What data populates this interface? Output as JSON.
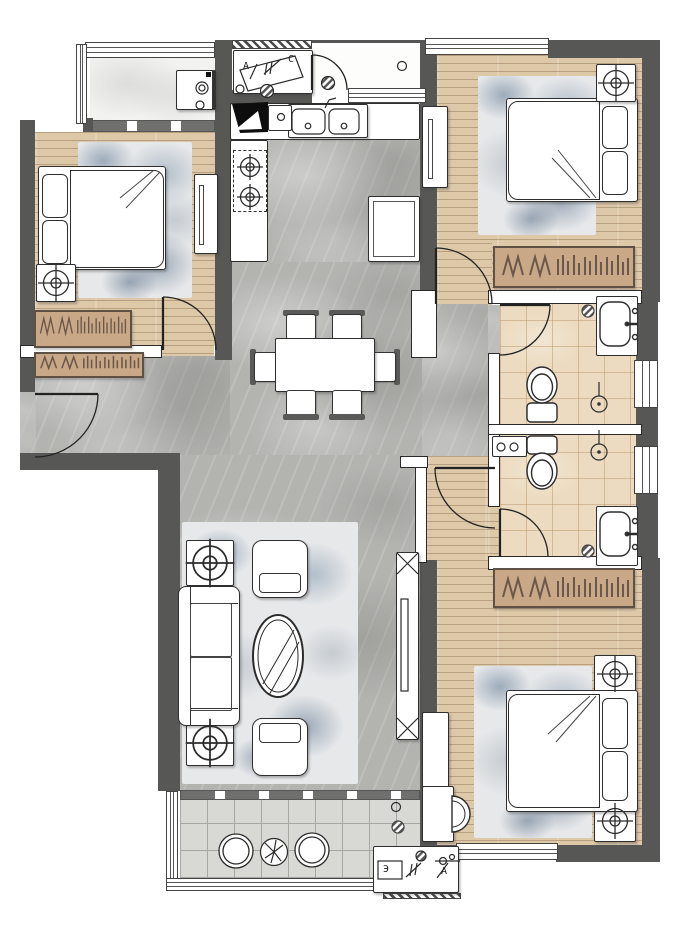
{
  "title": "apartment-floor-plan",
  "colors": {
    "wall": "#575755",
    "wood_floor": "#ddc8a8",
    "marble_floor": "#b3b3b0",
    "white_marble_floor": "#f2f2f0",
    "bath_tile": "#ecdbc0",
    "balcony_tile": "#d8d8d4",
    "wardrobe": "#c9a887",
    "rug_accent": "#54718a",
    "furniture": "#ffffff"
  },
  "legends": {
    "top_box": {
      "letters": [
        "A",
        "C"
      ]
    },
    "bottom_box": {
      "letters": [
        "Э",
        "A"
      ]
    }
  },
  "rooms": [
    {
      "name": "laundry-balcony-top-left",
      "floor": "white-marble",
      "items": [
        "window",
        "washing-machine"
      ]
    },
    {
      "name": "bedroom-top-left",
      "floor": "wood",
      "items": [
        "double-bed",
        "pillows",
        "rug",
        "lamp-table",
        "tv-cabinet",
        "wardrobe",
        "closet",
        "door"
      ]
    },
    {
      "name": "utility-foyer-top",
      "floor": "plain",
      "items": [
        "legend-box",
        "door",
        "pass-window",
        "drain"
      ]
    },
    {
      "name": "kitchen",
      "floor": "marble",
      "items": [
        "double-sink",
        "gas-stove-2-burner",
        "counter",
        "fridge-cabinet",
        "corner-unit"
      ]
    },
    {
      "name": "bedroom-top-right",
      "floor": "wood",
      "items": [
        "double-bed",
        "pillows",
        "rug",
        "lamp-table",
        "tv-cabinet",
        "wardrobe",
        "door"
      ]
    },
    {
      "name": "dining-area",
      "floor": "marble",
      "items": [
        "dining-table",
        "chair",
        "chair",
        "chair",
        "chair",
        "chair",
        "chair"
      ]
    },
    {
      "name": "bathroom-upper",
      "floor": "tile",
      "items": [
        "vanity-sink",
        "toilet",
        "shower-drain",
        "floor-drain",
        "door",
        "window"
      ]
    },
    {
      "name": "bathroom-lower",
      "floor": "tile",
      "items": [
        "vanity-sink",
        "toilet",
        "shower-drain",
        "floor-drain",
        "hookup-counter",
        "door",
        "window"
      ]
    },
    {
      "name": "living-area",
      "floor": "marble",
      "items": [
        "sofa",
        "armchair",
        "armchair",
        "coffee-table",
        "side-table",
        "side-table",
        "rug",
        "tv-console"
      ]
    },
    {
      "name": "bedroom-bottom-right",
      "floor": "wood",
      "items": [
        "double-bed",
        "pillows",
        "rug",
        "lamp-table",
        "lamp-table",
        "wardrobe",
        "desk",
        "chair",
        "cabinet",
        "window",
        "door"
      ]
    },
    {
      "name": "balcony-bottom",
      "floor": "tile-grid",
      "items": [
        "round-chair",
        "round-chair",
        "plant-table",
        "legend-box",
        "glass-railing",
        "sliding-door"
      ]
    }
  ]
}
